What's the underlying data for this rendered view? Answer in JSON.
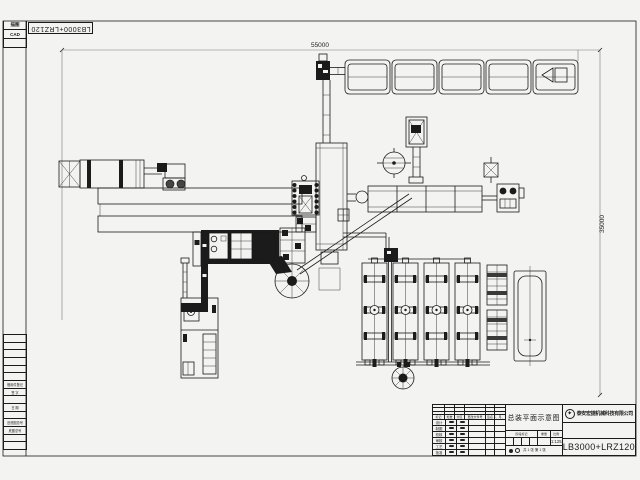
{
  "sheet": {
    "background": "#f3f3f1",
    "line_color": "#1b1b1b"
  },
  "margin": {
    "corner_rows": [
      "描图",
      "CAD",
      ""
    ],
    "rotated_code": "LB3000+LRZ120",
    "table_rows": [
      "",
      "",
      "",
      "",
      "",
      "",
      "借用件登记",
      "签 字",
      "",
      "日 期",
      "",
      "旧底图总号",
      "底图总号",
      "",
      ""
    ]
  },
  "dimensions": {
    "overall_width": "55000",
    "overall_height": "35000"
  },
  "title_block": {
    "drawing_title": "总装平面示意图",
    "company_name": "泰安宏捷机械科技有限公司",
    "drawing_number": "LB3000+LRZ120",
    "revision_header": [
      "标记",
      "处数",
      "分区",
      "更改文件号",
      "签名",
      "年、月、日"
    ],
    "signature_rows": [
      "设计",
      "制图",
      "校核",
      "审核",
      "工艺",
      "批准"
    ],
    "stage_header": [
      "阶段标记",
      "重量",
      "比例"
    ],
    "scale_value": "1:125",
    "sheet_note": "共 1 张  第 1 张"
  }
}
